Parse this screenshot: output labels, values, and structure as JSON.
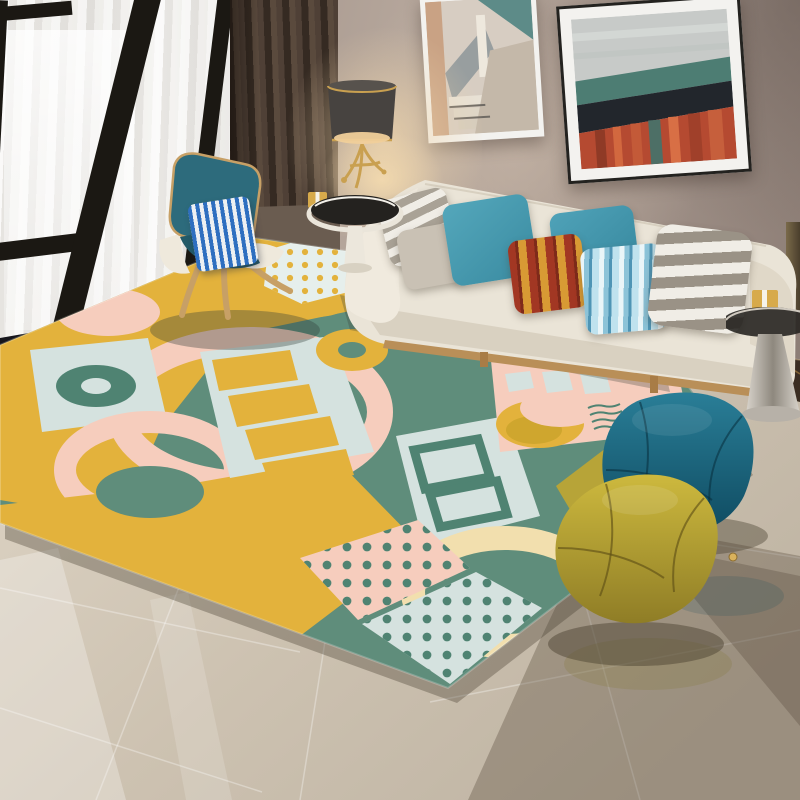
{
  "scene": {
    "setting": "modern living room interior render",
    "subject": "geometric patterned area rug with sofa, shell chair and poufs",
    "lighting": "warm lamp glow with daylight from floor-to-ceiling window",
    "floor": "glossy beige large-format tiles with reflections"
  },
  "palette": {
    "window_frame": "#1b1813",
    "glass_bright": "#f6f5f3",
    "curtain_dark": "#42352c",
    "frame_white": "#f3f2ef",
    "frame_black": "#23221f",
    "wall_base": "#a3948b",
    "sill_marble": "#15151a",
    "baseboard_marble": "#3b2d22",
    "floor_light": "#e0d7c8",
    "floor_mid": "#cdc2b1",
    "floor_dark": "#bfb4a3",
    "sofa_cream": "#eae4d7",
    "sofa_seat_shadow": "#d9d1c1",
    "sofa_wood": "#b98f58",
    "pillow_taupe": "#c9c1b4",
    "lamp_shade": "#474340",
    "lamp_gold": "#c9a050",
    "lamp_glow": "#f0cf9a",
    "table_white": "#ece7dc",
    "glass_dark": "#24221f",
    "chrome_light": "#d8d3cb",
    "chrome_dark": "#8e887e",
    "gift_gold": "#d7aa4b",
    "chair_teal": "#2d6b7c",
    "chair_teal_dark": "#235a68",
    "chair_wood": "#c7a066",
    "chair_cream": "#efe9dc",
    "rug_teal": "#5f8d7b",
    "rug_teal_deep": "#4f8372",
    "rug_yellow": "#e3b23c",
    "rug_yellow_deep": "#cfa62e",
    "rug_blue": "#d5e2df",
    "rug_white": "#e6efec",
    "rug_pink": "#f6cdbd",
    "rug_cream": "#f2dfae",
    "rug_olive": "#b7a438",
    "pouf_teal_light": "#2a7e97",
    "pouf_teal_dark": "#0e4a60",
    "pouf_olive_light": "#cdb93e",
    "pouf_olive_dark": "#8f7d26",
    "art1_bg": "#d7cdc2",
    "art1_teal": "#5d8b88",
    "art1_tan": "#c9a284",
    "art1_grey": "#989e9f",
    "art2_sky": "#c7cac8",
    "art2_teal": "#4d7d73",
    "art2_dark": "#22262c",
    "art2_red": "#b54a31"
  },
  "objects": {
    "window": {
      "type": "floor-to-ceiling window",
      "frame": "black aluminium",
      "sheer_curtain": true,
      "mullions": 3
    },
    "curtain": {
      "type": "pleated drape",
      "color_ref": "curtain_dark"
    },
    "wall_art": [
      {
        "name": "abstract-staircase-print",
        "frame": "white",
        "motifs": [
          "teal triangle",
          "tan strip",
          "grey stair band"
        ]
      },
      {
        "name": "abstract-landscape-print",
        "frame": "black with white mat",
        "bands": [
          "grey sky",
          "teal sea",
          "dark berm",
          "red strata"
        ]
      }
    ],
    "table_lamp": {
      "shade": "dark drum with gold rims",
      "base": "gold sculptural branches",
      "lit": true
    },
    "side_table_left": {
      "top": "smoked glass on white rim",
      "pedestal": "white cone",
      "decor": [
        "gift box",
        "gold ornament"
      ]
    },
    "sofa": {
      "upholstery_ref": "sofa_cream",
      "base": "wood rail with legs",
      "pillows": [
        {
          "pattern": "horizontal stripes",
          "colors": [
            "white",
            "grey"
          ]
        },
        {
          "pattern": "solid",
          "colors": [
            "taupe"
          ]
        },
        {
          "pattern": "solid",
          "colors": [
            "teal"
          ]
        },
        {
          "pattern": "solid",
          "colors": [
            "teal"
          ]
        },
        {
          "pattern": "vertical stripes",
          "colors": [
            "dark red",
            "amber"
          ]
        },
        {
          "pattern": "vertical stripes",
          "colors": [
            "light blue",
            "steel blue",
            "white"
          ]
        },
        {
          "pattern": "horizontal stripes",
          "colors": [
            "white",
            "grey"
          ]
        }
      ]
    },
    "lounge_chair": {
      "style": "wing shell chair",
      "shell_ref": "chair_teal",
      "frame_ref": "chair_wood",
      "pillow": {
        "pattern": "vertical stripes",
        "colors": [
          "blue",
          "white"
        ]
      }
    },
    "rug": {
      "style": "geometric colour-block",
      "colors_refs": [
        "rug_yellow",
        "rug_teal",
        "rug_blue",
        "rug_pink",
        "rug_cream",
        "rug_olive"
      ],
      "motifs": [
        "pink ring arcs",
        "teal donut on blue square",
        "yellow ladder bars",
        "yellow circle and donut",
        "dotted hexagon",
        "yellow-dot panel",
        "wavy squiggles",
        "teal square outlines",
        "blue bars on pink",
        "yellow half-moon",
        "cream ring",
        "teal dots on pink",
        "teal dots on blue",
        "teal semicircle"
      ]
    },
    "poufs": [
      {
        "shape": "faceted cube",
        "color_ref": "pouf_teal_dark"
      },
      {
        "shape": "faceted cube",
        "color_ref": "pouf_olive_light"
      }
    ],
    "side_table_right": {
      "top": "smoked glass",
      "pedestal": "polished chrome cone",
      "decor": [
        "gift box"
      ]
    },
    "floor": {
      "material": "glossy beige tile",
      "reflections": [
        "window light streaks",
        "table and pouf shadows"
      ]
    },
    "accents": [
      {
        "name": "gold-knob-on-floor"
      },
      {
        "name": "gold-wall-pole-right-edge"
      }
    ]
  }
}
